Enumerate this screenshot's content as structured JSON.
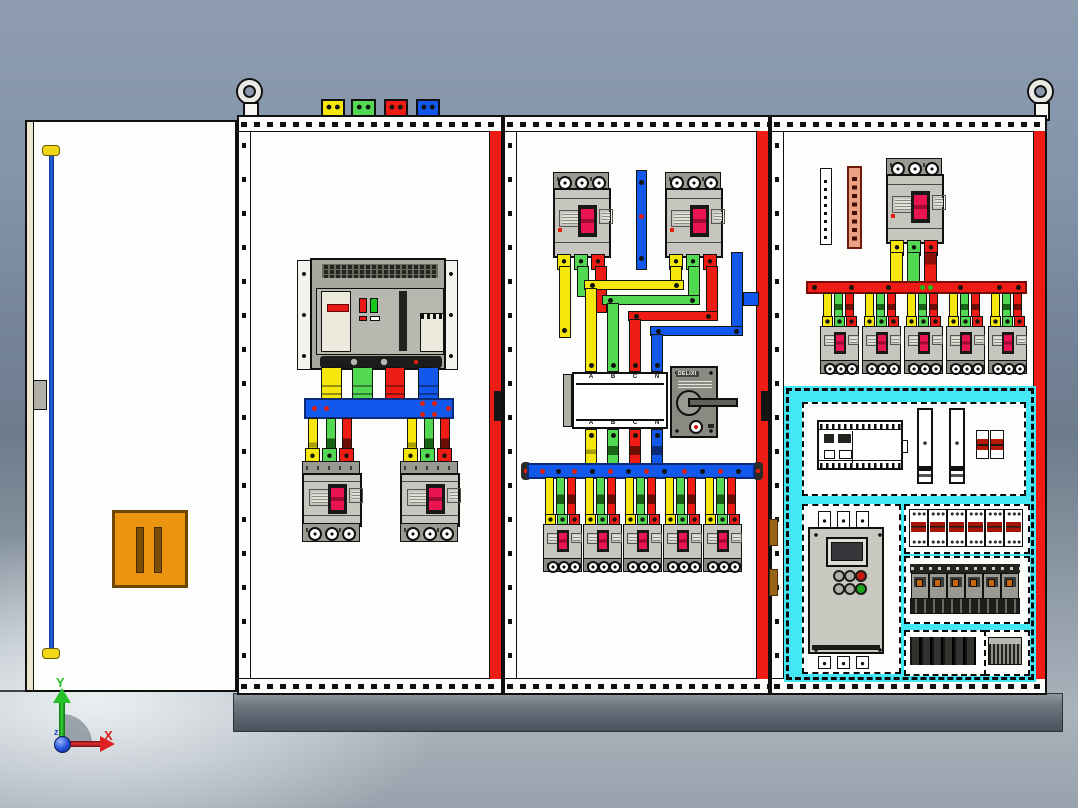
{
  "scene": {
    "axes": {
      "x": "X",
      "y": "Y",
      "z": "z"
    }
  },
  "changeover_switch": {
    "brand": "DELIXI",
    "top_terminals": [
      "A",
      "B",
      "C",
      "N"
    ],
    "bottom_terminals": [
      "A",
      "B",
      "C",
      "N"
    ]
  },
  "roof_phase_blocks": [
    "yellow",
    "green",
    "red",
    "blue"
  ],
  "counts": {
    "cabinet_bays": 3,
    "lifting_eyes": 2,
    "bay1_feeder_breakers": 2,
    "bay2_incoming_breakers": 2,
    "bay2_outgoing_breakers": 5,
    "bay3_outgoing_breakers": 5,
    "din_rail_breakers": 6,
    "terminal_relay_modules": 6,
    "contactor_modules": 6
  },
  "colors": {
    "phase_yellow": "#f5e70c",
    "phase_green": "#52d852",
    "phase_red": "#ee1c14",
    "neutral_blue": "#1258ec",
    "highlight_cyan": "#42e8f6",
    "breaker_toggle_magenta": "#ea1450",
    "door_device_orange": "#ea9410",
    "copper_bar_salmon": "#eaa184",
    "cabinet_white": "#fdfdfb",
    "plinth_gray": "#626c76",
    "background_gray": "#8494a8",
    "axis_x_red": "#e02020",
    "axis_y_green": "#28c028",
    "origin_blue": "#2050d8"
  }
}
